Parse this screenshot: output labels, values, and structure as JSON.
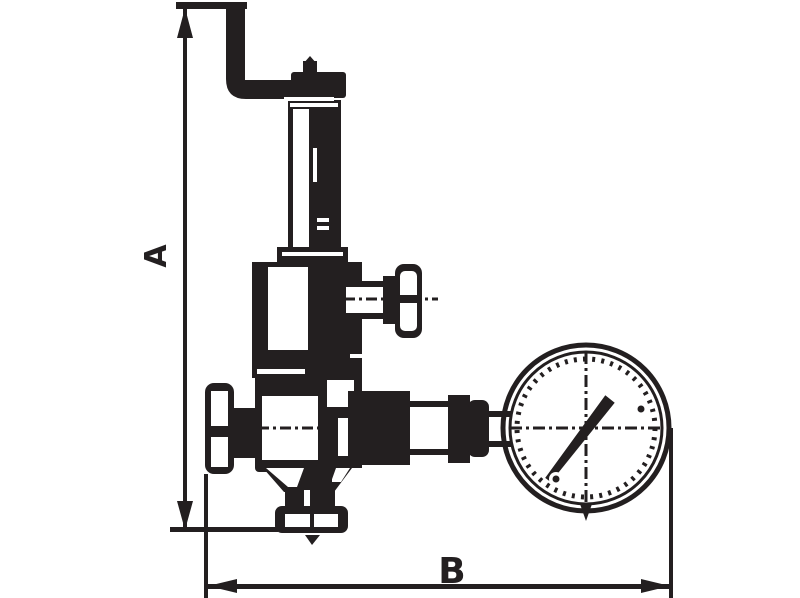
{
  "colors": {
    "ink": "#231f20",
    "background": "#ffffff"
  },
  "drawing": {
    "kind": "technical-dimensional-line-drawing",
    "subject": "pressure reducing valve with pressure gauge",
    "dimension_a": {
      "label": "A",
      "orientation": "vertical"
    },
    "dimension_b": {
      "label": "B",
      "orientation": "horizontal"
    },
    "parts": [
      "inlet-pipe",
      "top-cap",
      "spring-housing",
      "spring-bonnet",
      "adjusting-screw-handle",
      "handwheel",
      "valve-body",
      "outlet-connection",
      "pressure-gauge",
      "bottom-drain-fitting"
    ]
  }
}
